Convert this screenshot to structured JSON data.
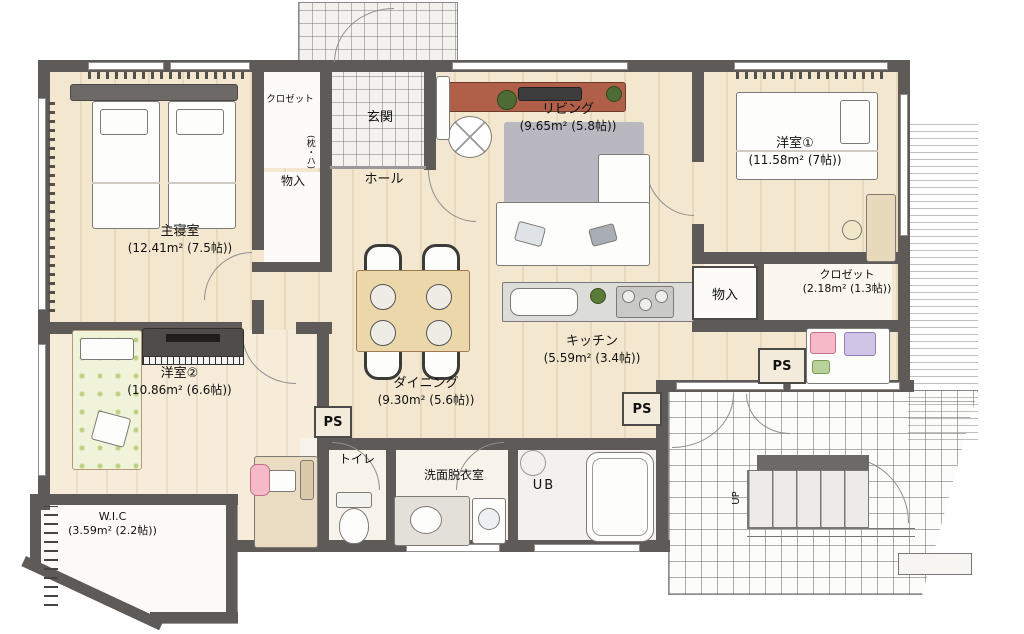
{
  "rooms": {
    "master": {
      "name": "主寝室",
      "area": "(12.41m² (7.5帖))"
    },
    "living": {
      "name": "リビング",
      "area": "(9.65m² (5.8帖))"
    },
    "western1": {
      "name": "洋室①",
      "area": "(11.58m² (7帖))"
    },
    "closet1": {
      "name": "クロゼット",
      "area": "(2.18m² (1.3帖))"
    },
    "kitchen": {
      "name": "キッチン",
      "area": "(5.59m² (3.4帖))"
    },
    "dining": {
      "name": "ダイニング",
      "area": "(9.30m² (5.6帖))"
    },
    "western2": {
      "name": "洋室②",
      "area": "(10.86m² (6.6帖))"
    },
    "wic": {
      "name": "W.I.C",
      "area": "(3.59m² (2.2帖))"
    }
  },
  "labels": {
    "entrance": "玄関",
    "hall": "ホール",
    "storage": "物入",
    "closet_small": "クロゼット",
    "closet_note": "(枕・ハ)",
    "toilet": "トイレ",
    "washroom": "洗面脱衣室",
    "unit_bath": "UB",
    "pipe_space": "PS",
    "stairs_up": "UP"
  },
  "colors": {
    "wall": "#5d5a58",
    "floor": "#f4e7cf",
    "tile": "#f3f2ee",
    "rug": "#b9b7bf",
    "tv_board": "#b05f49",
    "wood_table": "#ecd7ab",
    "floral_bed": "#f0f3da",
    "pink_chair": "#f5b9c8",
    "piano": "#4f4d4b"
  }
}
